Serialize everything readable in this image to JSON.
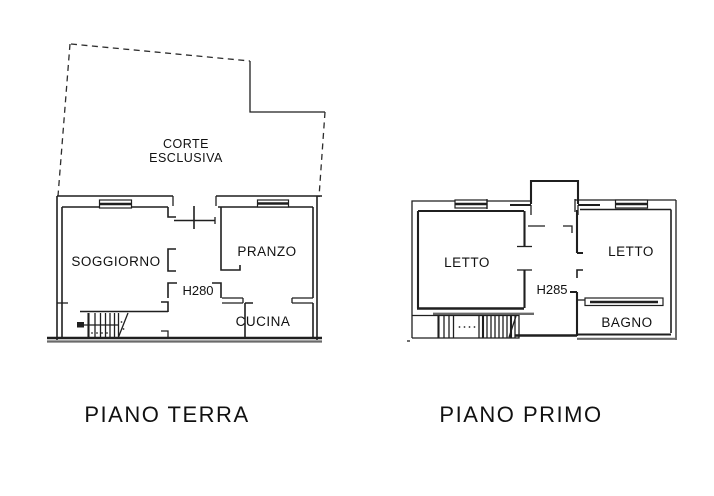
{
  "page_title": "Floor plans",
  "colors": {
    "line": "#1f1f1f",
    "wall_gray": "#6a6a6a",
    "background": "#ffffff"
  },
  "ground_floor": {
    "caption": "PIANO TERRA",
    "courtyard_line1": "CORTE",
    "courtyard_line2": "ESCLUSIVA",
    "living_room": "SOGGIORNO",
    "dining_room": "PRANZO",
    "kitchen": "CUCINA",
    "ceiling_height": "H280"
  },
  "first_floor": {
    "caption": "PIANO PRIMO",
    "bedroom_left": "LETTO",
    "bedroom_right": "LETTO",
    "bathroom": "BAGNO",
    "ceiling_height": "H285"
  }
}
